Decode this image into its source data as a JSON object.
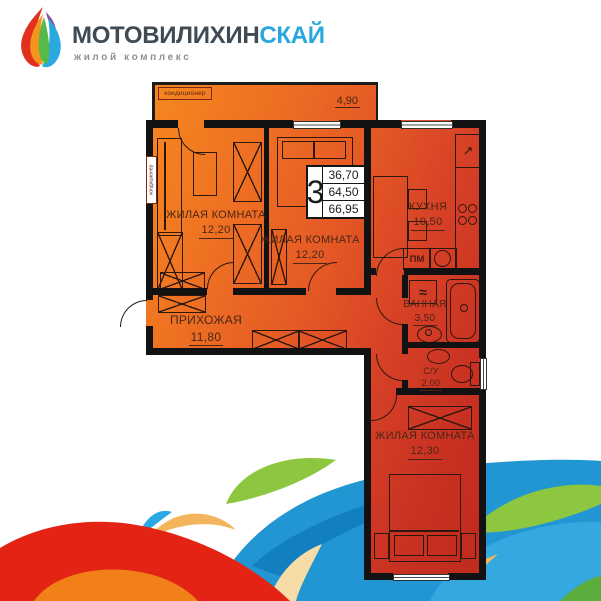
{
  "logo": {
    "brand_main": "МОТОВИЛИХИН",
    "brand_accent": "СКАЙ",
    "subtitle": "жилой комплекс"
  },
  "floor_plan": {
    "summary": {
      "rooms_count": "3",
      "living_area": "36,70",
      "apartment_area": "64,50",
      "total_area": "66,95"
    },
    "balcony": {
      "ac_label": "кондиционер",
      "area": "4,90"
    },
    "wall_ac_label": "кондиционер",
    "rooms": {
      "living1": {
        "name": "ЖИЛАЯ КОМНАТА",
        "area": "12,20"
      },
      "living2": {
        "name": "ЖИЛАЯ КОМНАТА",
        "area": "12,20"
      },
      "kitchen": {
        "name": "КУХНЯ",
        "area": "10,50"
      },
      "hallway": {
        "name": "ПРИХОЖАЯ",
        "area": "11,80"
      },
      "bathroom": {
        "name": "ВАННАЯ",
        "area": "3,50"
      },
      "wc": {
        "name": "С/У",
        "area": "2,00"
      },
      "living3": {
        "name": "ЖИЛАЯ КОМНАТА",
        "area": "12,30"
      }
    },
    "appliances": {
      "dishwasher": "ПМ",
      "washer_symbol": "≈",
      "vent_symbol": "↗"
    }
  },
  "colors": {
    "brand_dark": "#3E4A54",
    "accent_blue": "#29A8E0",
    "plan_orange": "#F6891F",
    "plan_red": "#BE2A1C",
    "wave_red": "#E32414",
    "wave_blue": "#2196D3",
    "wave_green": "#8DC63F",
    "wave_sand": "#F2B45C"
  }
}
